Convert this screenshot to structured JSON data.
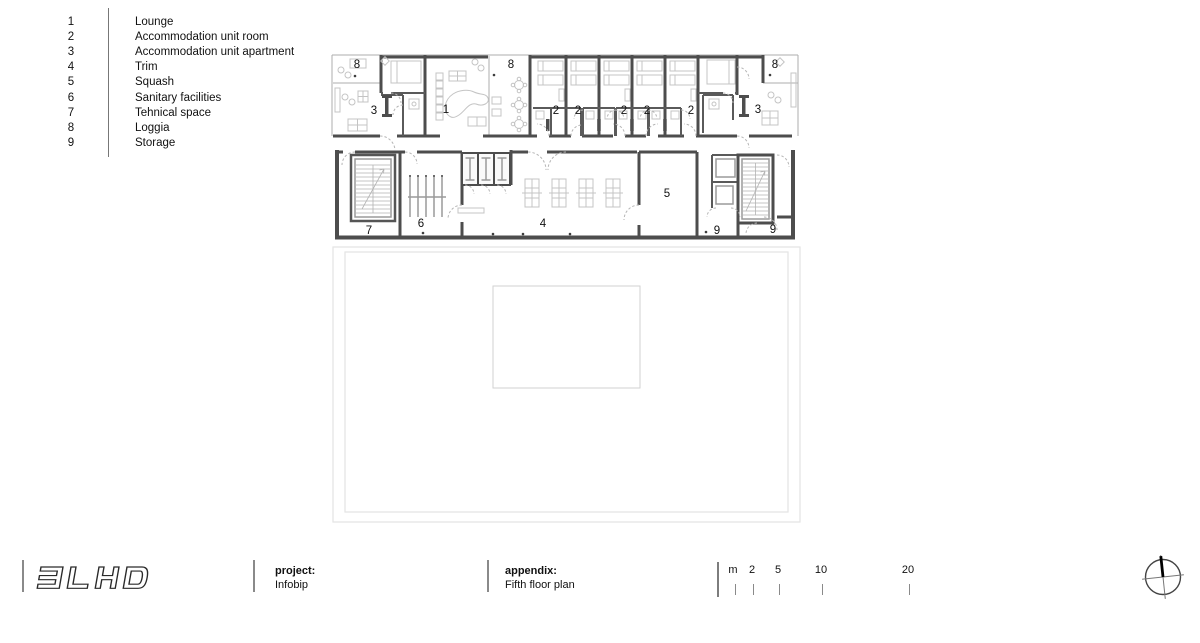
{
  "legend": {
    "items": [
      {
        "num": "1",
        "label": "Lounge"
      },
      {
        "num": "2",
        "label": "Accommodation unit room"
      },
      {
        "num": "3",
        "label": "Accommodation unit apartment"
      },
      {
        "num": "4",
        "label": "Trim"
      },
      {
        "num": "5",
        "label": "Squash"
      },
      {
        "num": "6",
        "label": "Sanitary facilities"
      },
      {
        "num": "7",
        "label": "Tehnical space"
      },
      {
        "num": "8",
        "label": "Loggia"
      },
      {
        "num": "9",
        "label": "Storage"
      }
    ]
  },
  "plan": {
    "room_labels": [
      "8",
      "3",
      "1",
      "8",
      "2",
      "2",
      "2",
      "2",
      "2",
      "3",
      "8",
      "7",
      "6",
      "4",
      "5",
      "9",
      "9"
    ]
  },
  "footer": {
    "logo": "3LHD",
    "project_label": "project:",
    "project_value": "Infobip",
    "appendix_label": "appendix:",
    "appendix_value": "Fifth floor plan",
    "scale_unit_labels": [
      "m",
      "2",
      "5",
      "10",
      "20"
    ]
  },
  "icons": {
    "north_arrow": "compass-circle-cross"
  },
  "colors": {
    "wall": "#4d4d4d",
    "furniture": "#c4c4c4",
    "terrace_line": "#e3e3e3",
    "divider": "#8a8a8a",
    "text": "#111111"
  }
}
